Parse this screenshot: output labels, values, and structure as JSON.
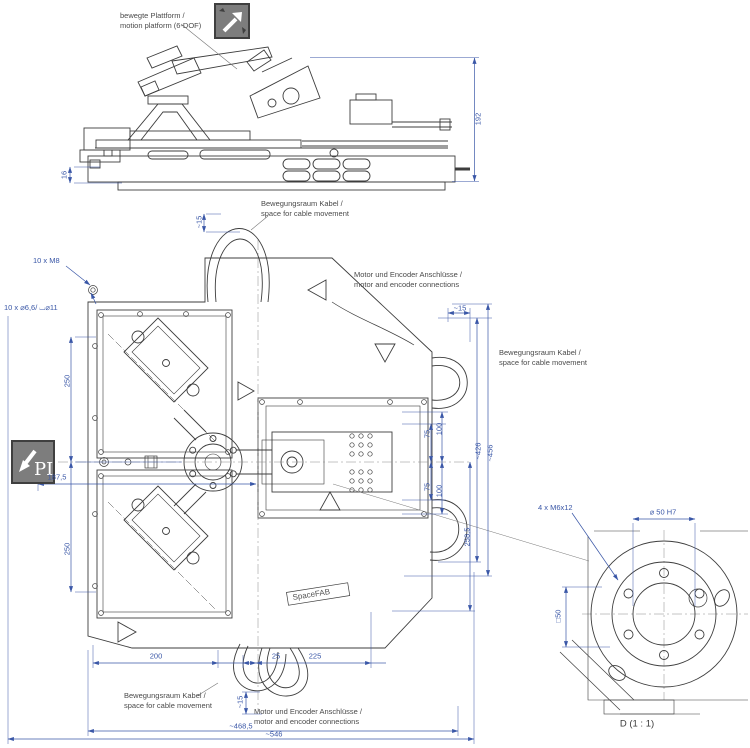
{
  "colors": {
    "dimension_blue": "#3a57a7",
    "line_dark": "#3d3d3d",
    "annotation_grey": "#4a4a4a",
    "icon_grey": "#7d7d7d",
    "background": "#ffffff"
  },
  "annotations": {
    "platform_de": "bewegte Plattform /",
    "platform_en": "motion platform (6-DOF)",
    "cable_space_de": "Bewegungsraum Kabel /",
    "cable_space_en": "space for cable movement",
    "motor_encoder_de": "Motor und Encoder Anschlüsse /",
    "motor_encoder_en": "motor and encoder connections",
    "thread_holes_top": "10 x M8",
    "through_holes": "10 x ⌀6,6/ ⌴⌀11",
    "detail_screws": "4 x M6x12",
    "detail_bore": "⌀ 50 H7",
    "detail_title": "D (1 : 1)",
    "product_marking": "SpaceFAB",
    "pi_logo_text": "PI"
  },
  "icons": {
    "motion_icon": "6-dof-motion-arrows",
    "pi_logo_icon": "pi-brand-logo"
  },
  "dimensions": {
    "height_192": "192",
    "base_16": "16",
    "cable_top_15": "~15",
    "cable_right_15": "~15",
    "width_426": "~426",
    "width_456": "~456",
    "pitch_250_upper": "250",
    "pitch_250_lower": "250",
    "offset_187_5": "187,5",
    "offset_75_upper": "75",
    "offset_100_upper": "100",
    "offset_75_lower": "75",
    "offset_100_lower": "100",
    "length_258_5": "258,5",
    "pitch_200": "200",
    "pitch_25": "25",
    "pitch_225": "225",
    "cable_bottom_15": "~15",
    "width_468_5": "~468,5",
    "width_546": "~546",
    "detail_square_50": "□50"
  }
}
